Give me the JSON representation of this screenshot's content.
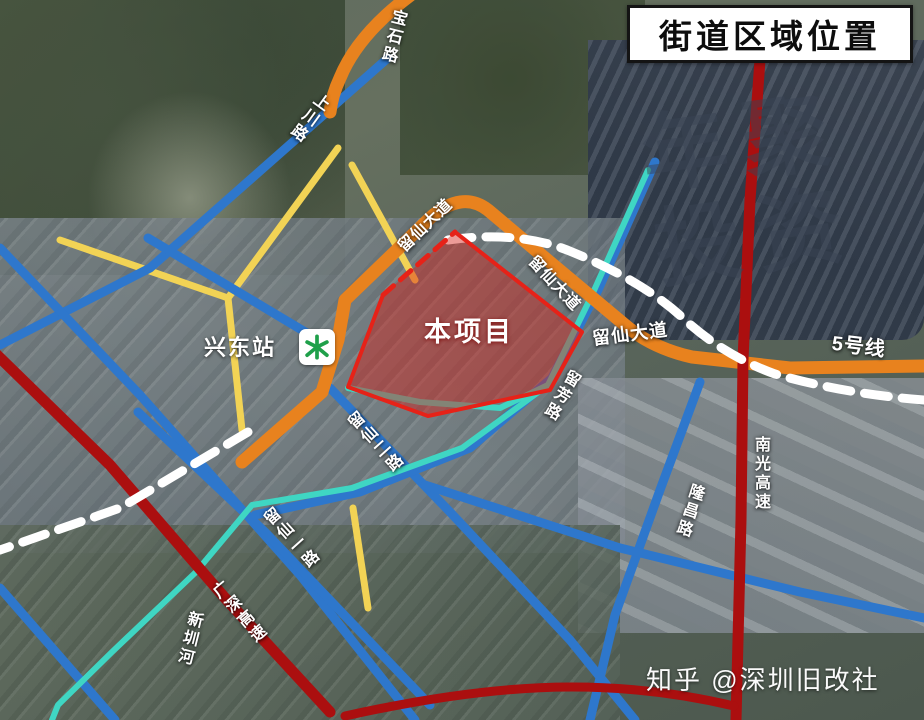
{
  "title": "街道区域位置",
  "project": {
    "label": "本项目"
  },
  "station": {
    "name": "兴东站"
  },
  "road_labels": {
    "baoshi": "宝石路",
    "shangchuan": "上川路",
    "liuxian_ave_west": "留仙大道",
    "liuxian_ave_mid": "留仙大道",
    "liuxian_ave_east": "留仙大道",
    "metro_line5": "5号线",
    "nanguang_expwy": "南光高速",
    "longchang": "隆昌路",
    "liufang": "留芳路",
    "liuxian_2": "留仙二路",
    "liuxian_1": "留仙一路",
    "guangshen_expwy": "广深高速",
    "xinzhen_river": "新圳河"
  },
  "watermark": {
    "line1": "年聚",
    "line2": "投资"
  },
  "credit": "知乎 @深圳旧改社",
  "legend_colors": {
    "arterial_orange": "#e8821e",
    "secondary_blue": "#2e77cc",
    "minor_yellow": "#f2d355",
    "expressway_red": "#ab0f0f",
    "river_teal": "#3fd6c3",
    "metro_dash": "#ffffff",
    "project_fill": "rgba(216,34,24,0.45)",
    "project_border": "#e62218",
    "metro_logo_green": "#1fa04a"
  }
}
